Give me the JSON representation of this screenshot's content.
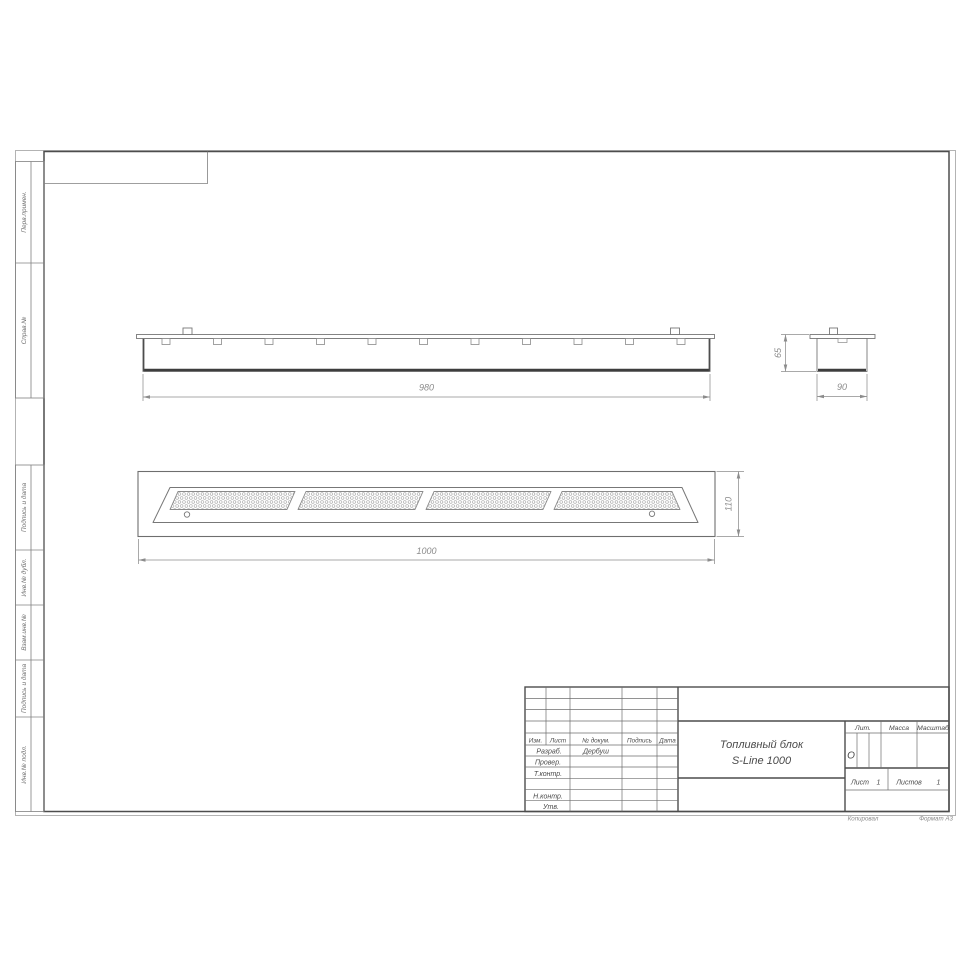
{
  "dimensions": {
    "front_width": "980",
    "side_height": "65",
    "side_width": "90",
    "plan_length": "1000",
    "plan_width": "110"
  },
  "margin_labels": {
    "perv_primen": "Перв.примен.",
    "sprav_no": "Справ.№",
    "podpis_data_1": "Подпись и дата",
    "inv_dubl": "Инв.№ дубл.",
    "vzam_inv": "Взам.инв.№",
    "podpis_data_2": "Подпись и дата",
    "inv_podl": "Инв.№ подл."
  },
  "title_block": {
    "title_line1": "Топливный блок",
    "title_line2": "S-Line 1000",
    "col_izm": "Изм.",
    "col_list": "Лист",
    "col_doc": "№ докум.",
    "col_podpis": "Подпись",
    "col_data": "Дата",
    "role_razrab": "Разраб.",
    "razrab_name": "Дербуш",
    "role_prover": "Провер.",
    "role_tkontr": "Т.контр.",
    "role_nkontr": "Н.контр.",
    "role_utv": "Утв.",
    "lit_label": "Лит.",
    "lit_value": "О",
    "mass_label": "Масса",
    "scale_label": "Масштаб",
    "list_label": "Лист",
    "list_value": "1",
    "listov_label": "Листов",
    "listov_value": "1"
  },
  "footer": {
    "copied_by": "Копировал",
    "format": "Формат А3"
  },
  "colors": {
    "paper_edge": "#b3b3b3",
    "frame": "#4d4d4d",
    "thin_line": "#808080",
    "drawing_line": "#777777",
    "thick_line": "#3d3d3d",
    "dim": "#8c8c8c",
    "stamp_text": "#4a4a4a"
  }
}
